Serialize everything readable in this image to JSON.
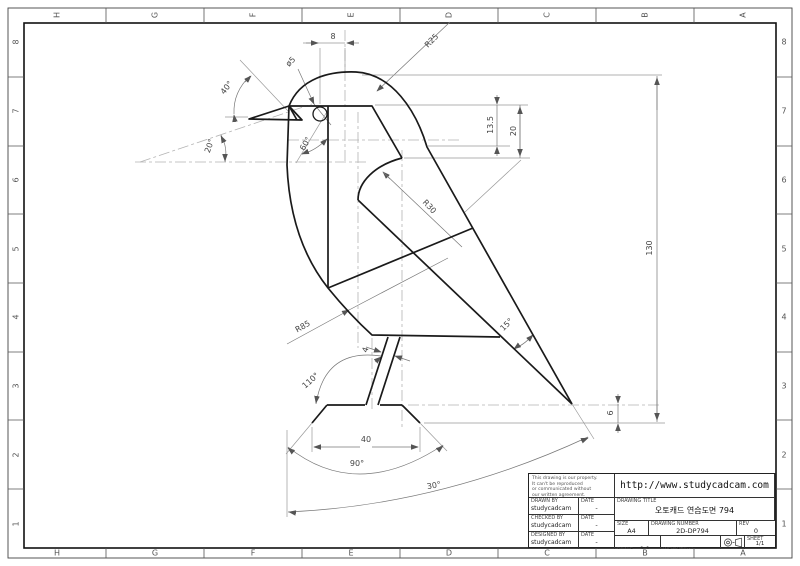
{
  "zones": {
    "top": [
      "H",
      "G",
      "F",
      "E",
      "D",
      "C",
      "B",
      "A"
    ],
    "bottom": [
      "H",
      "G",
      "F",
      "E",
      "D",
      "C",
      "B",
      "A"
    ],
    "left": [
      "8",
      "7",
      "6",
      "5",
      "4",
      "3",
      "2",
      "1"
    ],
    "right": [
      "8",
      "7",
      "6",
      "5",
      "4",
      "3",
      "2",
      "1"
    ]
  },
  "dims": {
    "d8": "8",
    "r25": "R25",
    "dia5": "ø5",
    "a40": "40°",
    "a20": "20°",
    "a60": "60°",
    "d13_5": "13.5",
    "d20": "20",
    "d130": "130",
    "r30": "R30",
    "r85": "R85",
    "a15": "15°",
    "d4": "4",
    "a110": "110°",
    "d40": "40",
    "a90": "90°",
    "a30": "30°",
    "d6": "6"
  },
  "tb": {
    "url": "http://www.studycadcam.com",
    "notes": [
      "This drawing is our property.",
      "It can't be reproduced",
      "or communicated without",
      "our written agreement."
    ],
    "drawn_by_label": "DRAWN BY",
    "drawn_by": "studycadcam",
    "checked_by_label": "CHECKED BY",
    "checked_by": "studycadcam",
    "designed_by_label": "DESIGNED BY",
    "designed_by": "studycadcam",
    "date_label": "DATE",
    "date_value": "-",
    "drawing_title_label": "DRAWING TITLE",
    "title": "오토캐드 연습도면 794",
    "size_label": "SIZE",
    "size": "A4",
    "number_label": "DRAWING NUMBER",
    "number": "2D-DP794",
    "rev_label": "REV",
    "rev": "0",
    "scale_label": "SCALE",
    "scale": "1:1",
    "weight_label": "WEIGHT(kg)",
    "weight": "-",
    "sheet_label": "SHEET",
    "sheet": "1/1"
  }
}
